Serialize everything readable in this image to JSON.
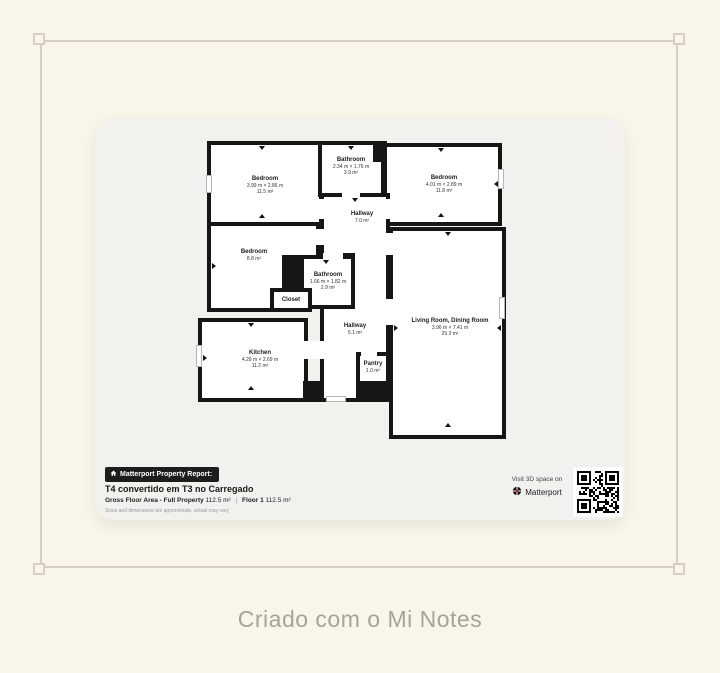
{
  "page": {
    "background_color": "#f9f6e9",
    "frame_color": "#d7d0c2",
    "caption": "Criado com o Mi Notes",
    "caption_color": "#a7a396"
  },
  "floorplan": {
    "wall_color": "#161616",
    "rooms": [
      {
        "id": "bedroom-top-left",
        "name": "Bedroom",
        "dims": "3.99 m × 2.86 m",
        "area": "11.5 m²"
      },
      {
        "id": "bathroom-top",
        "name": "Bathroom",
        "dims": "2.34 m × 1.76 m",
        "area": "3.9 m²"
      },
      {
        "id": "bedroom-top-right",
        "name": "Bedroom",
        "dims": "4.01 m × 2.89 m",
        "area": "11.8 m²"
      },
      {
        "id": "hallway-upper",
        "name": "Hallway",
        "area": "7.0 m²"
      },
      {
        "id": "bedroom-left",
        "name": "Bedroom",
        "area": "8.8 m²"
      },
      {
        "id": "bathroom-middle",
        "name": "Bathroom",
        "dims": "1.66 m × 1.82 m",
        "area": "2.9 m²"
      },
      {
        "id": "closet",
        "name": "Closet"
      },
      {
        "id": "kitchen",
        "name": "Kitchen",
        "dims": "4.29 m × 2.69 m",
        "area": "11.2 m²"
      },
      {
        "id": "hallway-lower",
        "name": "Hallway",
        "area": "5.1 m²"
      },
      {
        "id": "pantry",
        "name": "Pantry",
        "area": "1.0 m²"
      },
      {
        "id": "living-room",
        "name": "Living Room, Dining Room",
        "dims": "3.96 m × 7.41 m",
        "area": "29.3 m²"
      }
    ]
  },
  "report": {
    "badge_label": "Matterport Property Report:",
    "title": "T4 convertido em T3 no Carregado",
    "stats": {
      "gross_label": "Gross Floor Area - Full Property",
      "gross_value": "112.5 m²",
      "divider": "|",
      "floor_label": "Floor 1",
      "floor_value": "112.5 m²"
    },
    "disclaimer": "Sizes and dimensions are approximate, actual may vary",
    "visit_text": "Visit 3D space on",
    "brand": "Matterport"
  }
}
